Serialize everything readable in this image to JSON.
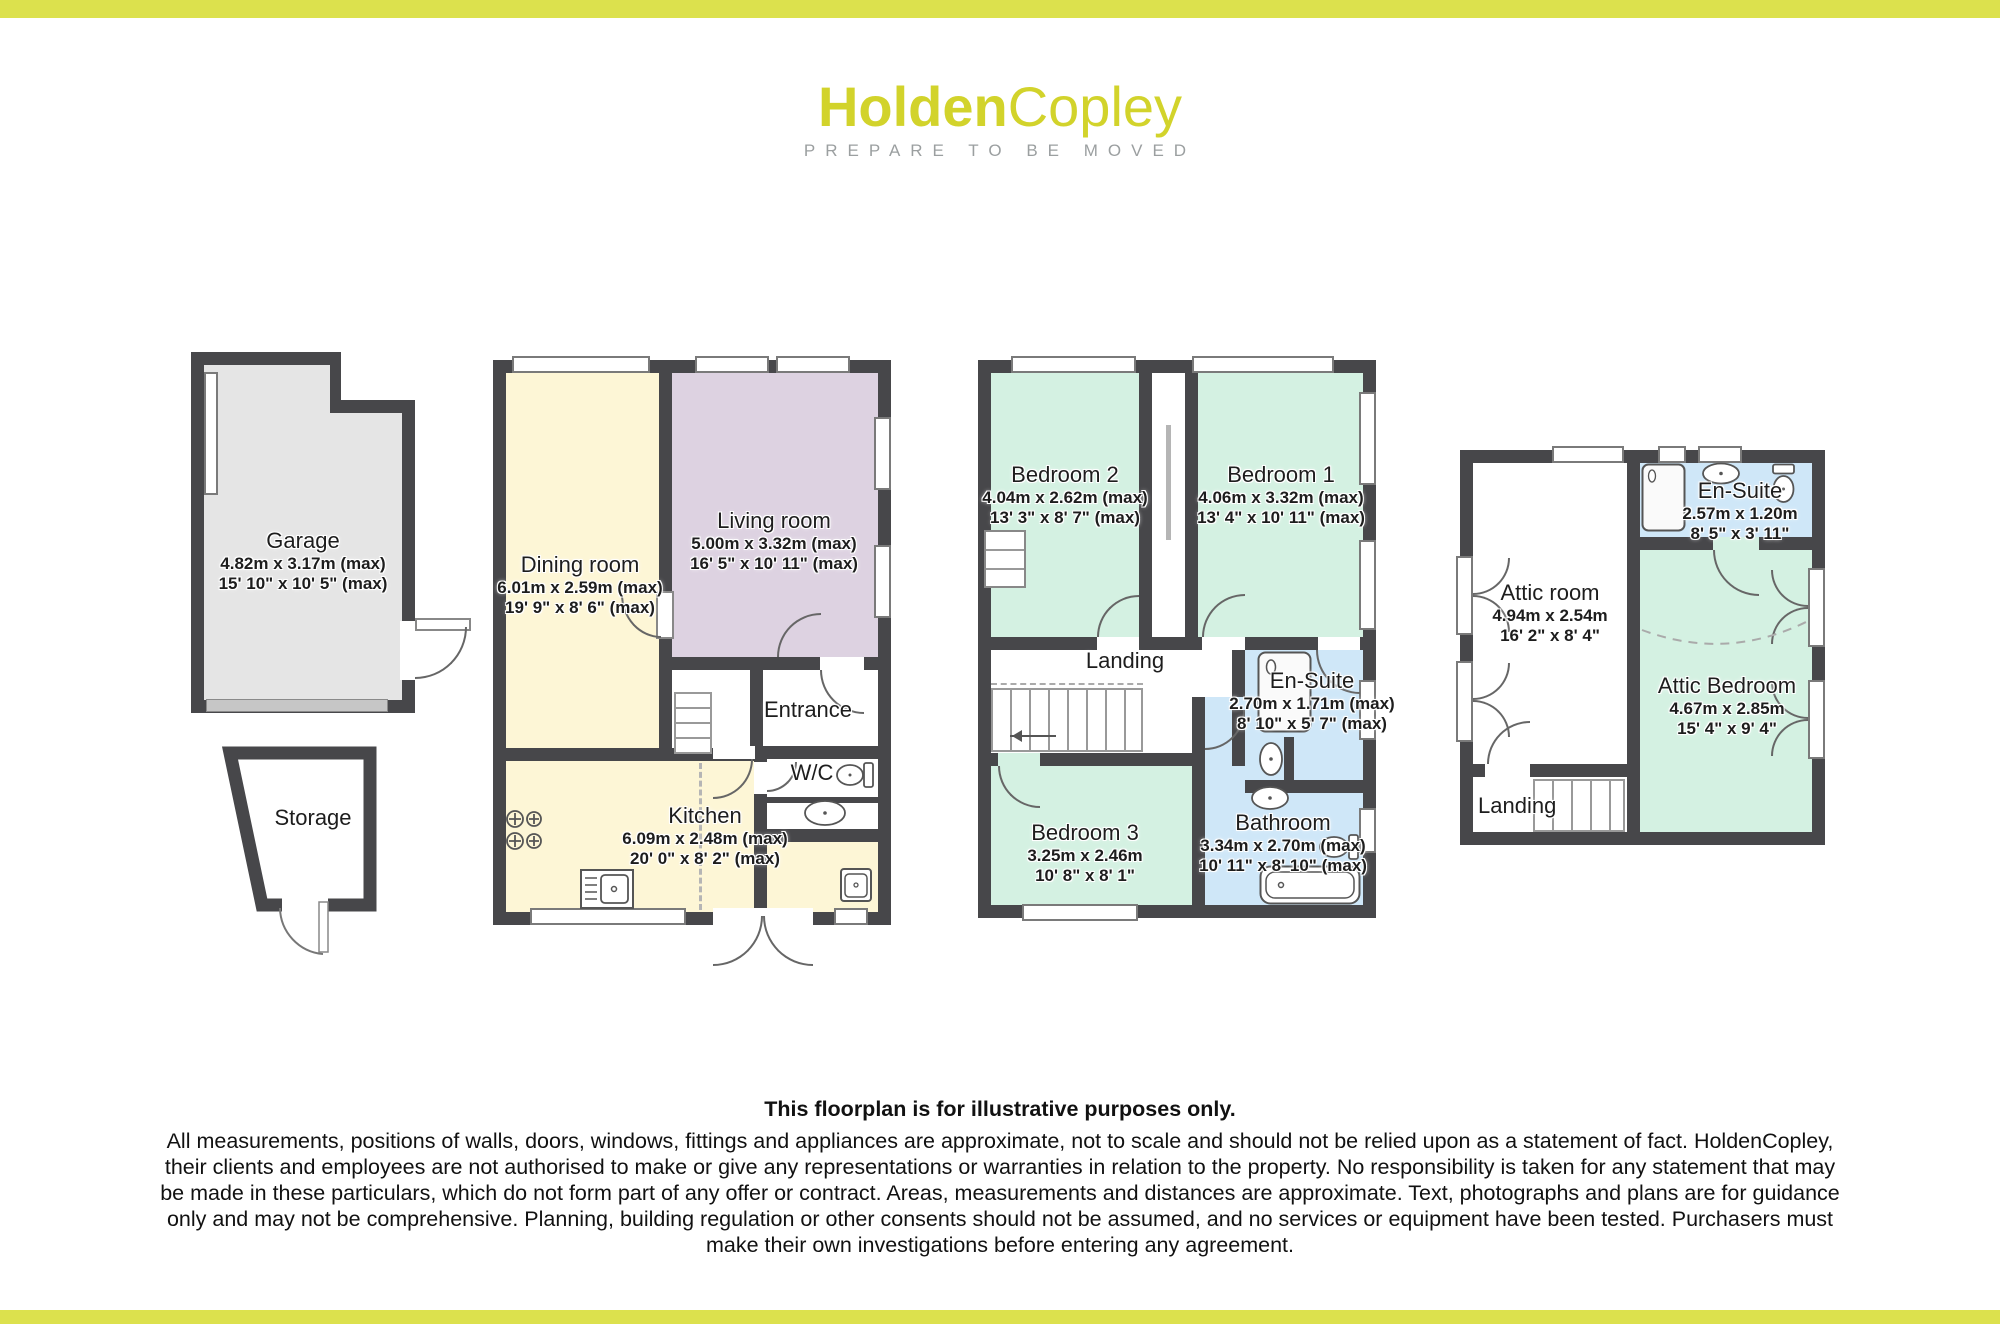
{
  "header": {
    "logo_part1": "Holden",
    "logo_part2": "Copley",
    "tagline": "PREPARE TO BE MOVED"
  },
  "rooms": {
    "garage": {
      "name": "Garage",
      "metric": "4.82m x 3.17m (max)",
      "imperial": "15' 10\" x 10' 5\" (max)"
    },
    "storage": {
      "name": "Storage"
    },
    "dining_room": {
      "name": "Dining room",
      "metric": "6.01m x 2.59m (max)",
      "imperial": "19' 9\" x 8' 6\" (max)"
    },
    "living_room": {
      "name": "Living room",
      "metric": "5.00m x 3.32m (max)",
      "imperial": "16' 5\" x 10' 11\" (max)"
    },
    "entrance": {
      "name": "Entrance"
    },
    "wc": {
      "name": "W/C"
    },
    "kitchen": {
      "name": "Kitchen",
      "metric": "6.09m x 2.48m (max)",
      "imperial": "20' 0\" x 8' 2\" (max)"
    },
    "bedroom2": {
      "name": "Bedroom 2",
      "metric": "4.04m x 2.62m (max)",
      "imperial": "13' 3\" x 8' 7\" (max)"
    },
    "bedroom1": {
      "name": "Bedroom 1",
      "metric": "4.06m x 3.32m (max)",
      "imperial": "13' 4\" x 10' 11\" (max)"
    },
    "landing1": {
      "name": "Landing"
    },
    "ensuite1": {
      "name": "En-Suite",
      "metric": "2.70m x 1.71m (max)",
      "imperial": "8' 10\" x 5' 7\" (max)"
    },
    "bedroom3": {
      "name": "Bedroom 3",
      "metric": "3.25m x 2.46m",
      "imperial": "10' 8\" x 8' 1\""
    },
    "bathroom": {
      "name": "Bathroom",
      "metric": "3.34m x 2.70m (max)",
      "imperial": "10' 11\" x 8' 10\" (max)"
    },
    "attic_room": {
      "name": "Attic room",
      "metric": "4.94m x 2.54m",
      "imperial": "16' 2\" x 8' 4\""
    },
    "ensuite2": {
      "name": "En-Suite",
      "metric": "2.57m x 1.20m",
      "imperial": "8' 5\" x 3' 11\""
    },
    "attic_bedroom": {
      "name": "Attic Bedroom",
      "metric": "4.67m x 2.85m",
      "imperial": "15' 4\" x 9' 4\""
    },
    "landing2": {
      "name": "Landing"
    }
  },
  "disclaimer": {
    "title": "This floorplan is for illustrative purposes only.",
    "body": "All measurements, positions of walls, doors, windows, fittings and appliances are approximate, not to scale and should not be relied upon as a statement of fact. HoldenCopley, their clients and employees are not authorised to make or give any representations or warranties in relation to the property. No responsibility is taken for any statement that may be made in these particulars, which do not form part of any offer or contract. Areas, measurements and distances are approximate. Text, photographs and plans are for guidance only and may not be comprehensive. Planning, building regulation or other consents should not be assumed, and no services or equipment have been tested. Purchasers must make their own investigations before entering any agreement."
  },
  "colors": {
    "accent_bar": "#dce14d",
    "logo_yellow": "#d2d32b",
    "tagline_gray": "#9b9fa0",
    "wall": "#47474a",
    "room_yellow": "#fdf6d6",
    "room_mauve": "#ddd2e1",
    "room_green": "#d4f1e2",
    "room_blue": "#cfe7f8",
    "garage_floor": "#e5e5e5",
    "garage_door": "#c6c6c6"
  },
  "fixture_icons": [
    "hob-icon",
    "kitchen-sink-icon",
    "basin-icon",
    "toilet-icon",
    "bathtub-icon",
    "shower-icon",
    "stairs",
    "door-arc"
  ]
}
